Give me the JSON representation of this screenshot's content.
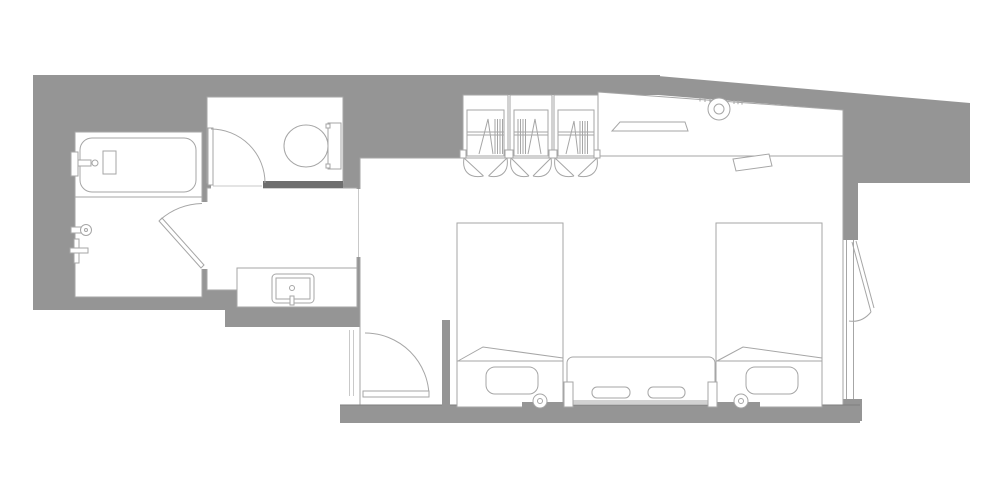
{
  "meta": {
    "title": "Hotel guest room floor plan",
    "type": "architectural-floor-plan",
    "canvas_width": 1000,
    "canvas_height": 500
  },
  "palette": {
    "background": "#ffffff",
    "wall_fill": "#959595",
    "wall_dark": "#6e6e6e",
    "line": "#a6a6a6",
    "line_soft": "#c9c9c9",
    "line_strong": "#7e7e7e",
    "floor": "#ffffff"
  },
  "labels": {
    "plan": "Hotel guest room floor plan",
    "bathroom": "Bathroom with bathtub and shower",
    "bathtub": "Bathtub",
    "shower": "Shower fixtures",
    "bathroom_door": "Bathroom swing door",
    "toilet_room": "Toilet room",
    "toilet": "Toilet",
    "toilet_door": "Toilet room swing door",
    "corridor": "Vanity corridor",
    "vanity": "Vanity counter with sink",
    "bedroom": "Bedroom with two twin beds",
    "entry_door": "Entry door",
    "closets": "Closets with bi-fold doors and hangers",
    "desk": "Desk counter with shelf, light and telephone",
    "bed1": "Twin bed 1",
    "bed2": "Twin bed 2",
    "console": "Bedside console with slippers",
    "window": "Window with casement pane"
  },
  "rooms": [
    {
      "id": "bathroom",
      "fixtures": [
        "bathtub",
        "tub-faucet",
        "shower-head",
        "shower-mixer",
        "swing-door"
      ]
    },
    {
      "id": "toilet-room",
      "fixtures": [
        "toilet",
        "swing-door"
      ]
    },
    {
      "id": "vanity-corridor",
      "fixtures": [
        "vanity-counter",
        "sink",
        "faucet"
      ]
    },
    {
      "id": "bedroom",
      "fixtures": [
        "entry-door",
        "closet-1",
        "closet-2",
        "closet-3",
        "desk-counter",
        "wall-shelf",
        "ceiling-light",
        "telephone",
        "twin-bed-1",
        "twin-bed-2",
        "pillow-1",
        "pillow-2",
        "reading-light-1",
        "reading-light-2",
        "bedside-console",
        "slippers-1",
        "slippers-2",
        "window",
        "casement-pane"
      ]
    }
  ]
}
